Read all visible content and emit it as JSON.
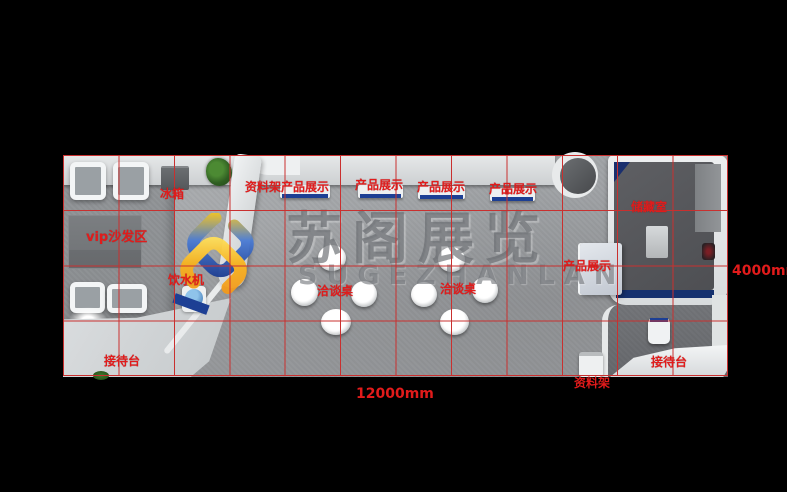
{
  "watermark": {
    "name_cn": "苏阁展览",
    "name_en": "SUGEZHANLAN"
  },
  "dimensions": {
    "width_label": "12000mm",
    "height_label": "4000mm"
  },
  "grid": {
    "columns": 12,
    "rows": 4,
    "cell_size_mm": 1000,
    "color": "#c9302f"
  },
  "colors": {
    "annotation_red": "#e11b1b",
    "accent_blue": "#1d3f94",
    "navy": "#16316f",
    "logo_blue": "#2e5bc6",
    "logo_yellow": "#f7c41d",
    "logo_orange": "#f2921c",
    "floor_gray": "#9b9ea1",
    "wall_light": "#d8dadb",
    "storage_dark": "#56575b"
  },
  "annotations": [
    {
      "text": "冰箱",
      "x": 160,
      "y": 188
    },
    {
      "text": "资料架",
      "x": 245,
      "y": 181
    },
    {
      "text": "产品展示",
      "x": 281,
      "y": 181
    },
    {
      "text": "产品展示",
      "x": 355,
      "y": 179
    },
    {
      "text": "产品展示",
      "x": 417,
      "y": 181
    },
    {
      "text": "产品展示",
      "x": 489,
      "y": 183
    },
    {
      "text": "储藏室",
      "x": 631,
      "y": 201
    },
    {
      "text": "vip沙发区",
      "x": 86,
      "y": 231,
      "size": 13
    },
    {
      "text": "产品展示",
      "x": 563,
      "y": 260
    },
    {
      "text": "饮水机",
      "x": 168,
      "y": 274
    },
    {
      "text": "洽谈桌",
      "x": 317,
      "y": 285
    },
    {
      "text": "洽谈桌",
      "x": 440,
      "y": 283
    },
    {
      "text": "接待台",
      "x": 104,
      "y": 355
    },
    {
      "text": "接待台",
      "x": 651,
      "y": 356
    },
    {
      "text": "资料架",
      "x": 574,
      "y": 377
    }
  ]
}
